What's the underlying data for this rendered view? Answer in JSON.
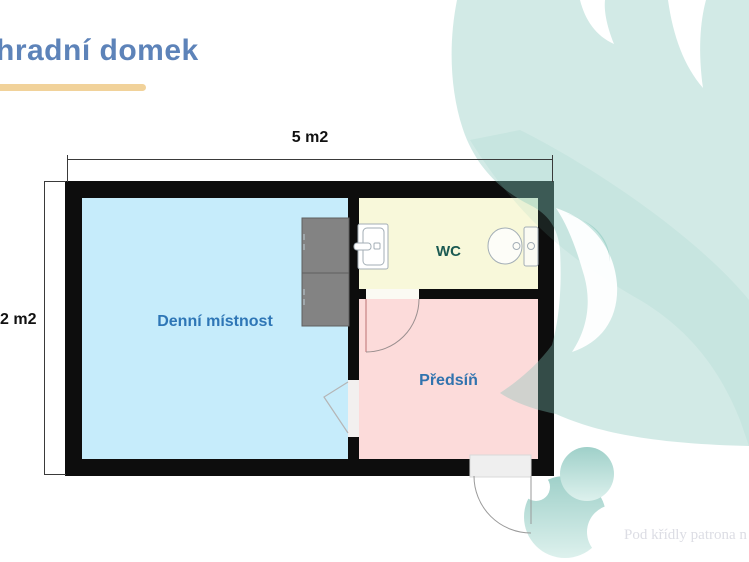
{
  "slide": {
    "title": "hradní domek",
    "title_color": "#5d83b9",
    "underline_color": "#f1d29a",
    "watermark": "Pod křídly patrona n",
    "decor": {
      "leaf_swoosh_color": "#d2eae6",
      "swirl_logo_color": "#a5d3cc"
    },
    "floorplan": {
      "top_dimension": "5 m2",
      "side_dimension": "2 m2",
      "wall_color": "#0d0d0d",
      "rooms": [
        {
          "name": "Denní místnost",
          "fill": "#c6ecfb",
          "label_color": "#2e76b6"
        },
        {
          "name": "WC",
          "fill": "#f8f8da",
          "label_color": "#1b5a52"
        },
        {
          "name": "Předsíň",
          "fill": "#fcdbda",
          "label_color": "#3173ae"
        }
      ],
      "fixtures": [
        "cabinet",
        "cabinet",
        "sink",
        "toilet",
        "door-swing",
        "door-swing",
        "opening-chevron"
      ]
    }
  }
}
